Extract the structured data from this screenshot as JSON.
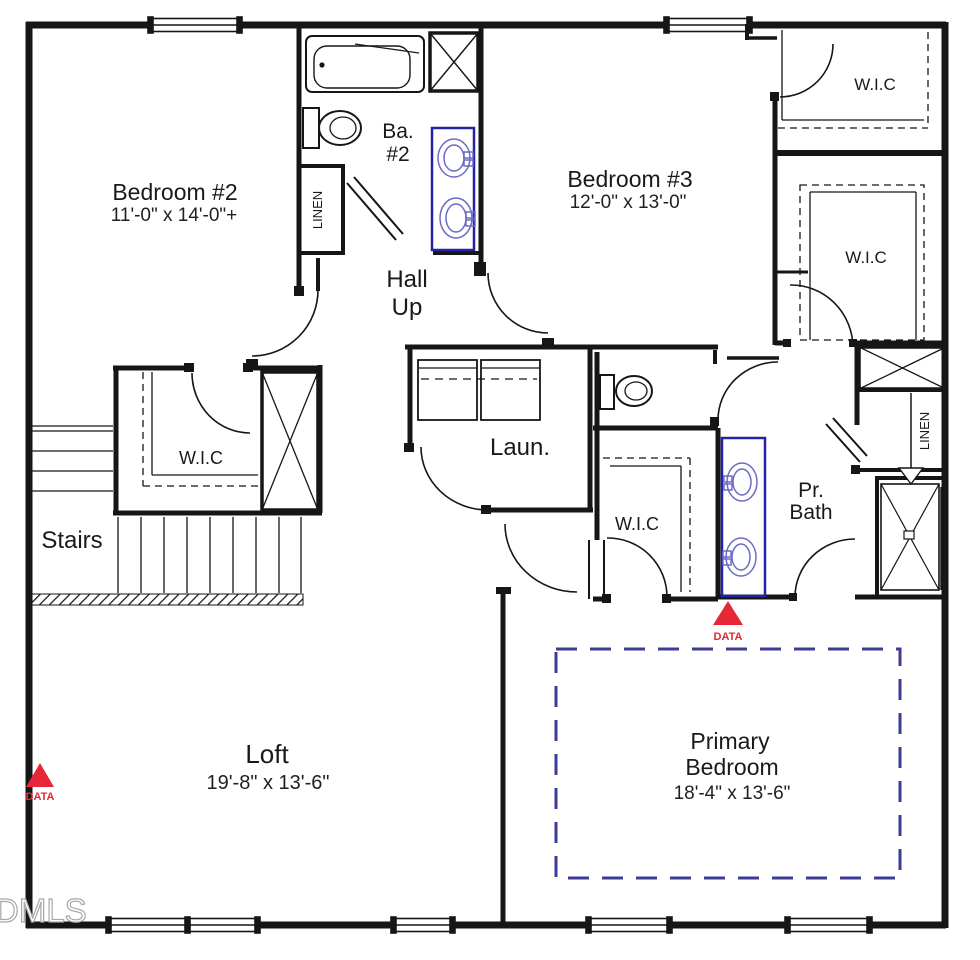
{
  "plan_title": "Second floor plan",
  "labels": {
    "bedroom2_name": "Bedroom #2",
    "bedroom2_dims": "11'-0\" x 14'-0\"+",
    "bedroom3_name": "Bedroom #3",
    "bedroom3_dims": "12'-0\" x 13'-0\"",
    "bath2_line1": "Ba.",
    "bath2_line2": "#2",
    "hall_line1": "Hall",
    "hall_line2": "Up",
    "wic": "W.I.C",
    "linen": "LINEN",
    "stairs": "Stairs",
    "laundry": "Laun.",
    "prbath_line1": "Pr.",
    "prbath_line2": "Bath",
    "loft_name": "Loft",
    "loft_dims": "19'-8\" x 13'-6\"",
    "primary_line1": "Primary",
    "primary_line2": "Bedroom",
    "primary_dims": "18'-4\" x 13'-6\"",
    "data_marker": "DATA",
    "watermark": "DMLS"
  },
  "markers": [
    {
      "label": "DATA",
      "location": "below primary bath vanity"
    },
    {
      "label": "DATA",
      "location": "left wall of loft"
    }
  ],
  "colors": {
    "wall": "#161616",
    "vanity_blue": "#2323a8",
    "fixture_blue": "#6b6bc4",
    "ceiling_dashed_blue": "#3c3c96",
    "data_red": "#e62737",
    "watermark_gray": "#a8a8a8"
  }
}
